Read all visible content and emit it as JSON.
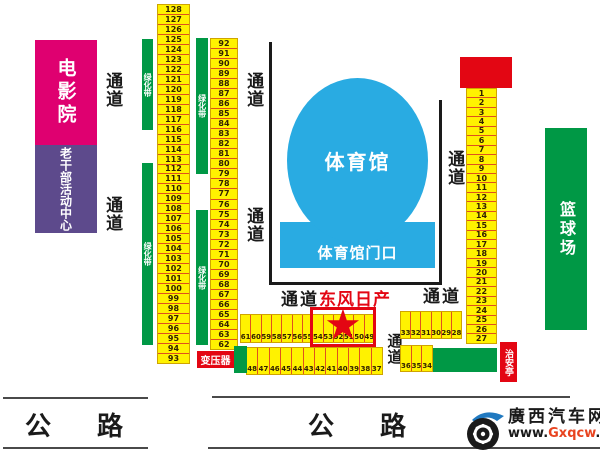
{
  "buildings": {
    "cinema": "电影院",
    "activity_center": "老干部活动中心",
    "stadium": "体育馆",
    "stadium_gate": "体育馆门口",
    "basketball_court": "篮球场"
  },
  "labels": {
    "passage": "通道",
    "greenbelt": "绿化带",
    "road": "公路",
    "transformer": "变压器",
    "security_booth": "治安亭",
    "dongfeng_nissan": "东风日产"
  },
  "stalls": {
    "col_left": [
      128,
      127,
      126,
      125,
      124,
      123,
      122,
      121,
      120,
      119,
      118,
      117,
      116,
      115,
      114,
      113,
      112,
      111,
      110,
      109,
      108,
      107,
      106,
      105,
      104,
      103,
      102,
      101,
      100,
      99,
      98,
      97,
      96,
      95,
      94,
      93
    ],
    "col_mid": [
      92,
      91,
      90,
      89,
      88,
      87,
      86,
      85,
      84,
      83,
      82,
      81,
      80,
      79,
      78,
      77,
      76,
      75,
      74,
      73,
      72,
      71,
      70,
      69,
      68,
      67,
      66,
      65,
      64,
      63,
      62
    ],
    "col_right": [
      1,
      2,
      3,
      4,
      5,
      6,
      7,
      8,
      9,
      10,
      11,
      12,
      13,
      14,
      15,
      16,
      17,
      18,
      19,
      20,
      21,
      22,
      23,
      24,
      25,
      26,
      27
    ],
    "row_a": [
      61,
      60,
      59,
      58,
      57,
      56,
      55,
      54,
      53,
      52,
      51,
      50,
      49
    ],
    "row_b": [
      48,
      47,
      46,
      45,
      44,
      43,
      42,
      41,
      40,
      39,
      38,
      37
    ],
    "row_c": [
      33,
      32,
      31,
      30,
      29,
      28
    ],
    "row_d": [
      36,
      35,
      34
    ]
  },
  "highlight": {
    "star": "★",
    "booth": "东风日产"
  },
  "logo": {
    "brand": "廣西汽车网",
    "url_prefix": "www.",
    "url_highlight": "Gxqcw",
    "url_suffix": ".com"
  },
  "colors": {
    "stall_yellow": "#FFF200",
    "stall_divider": "#E0501E",
    "green": "#009845",
    "stadium_blue": "#29ABE2",
    "cinema_magenta": "#DF0070",
    "activity_purple": "#5D4A8C",
    "red": "#E30613",
    "logo_url_orange": "#E8431F"
  }
}
